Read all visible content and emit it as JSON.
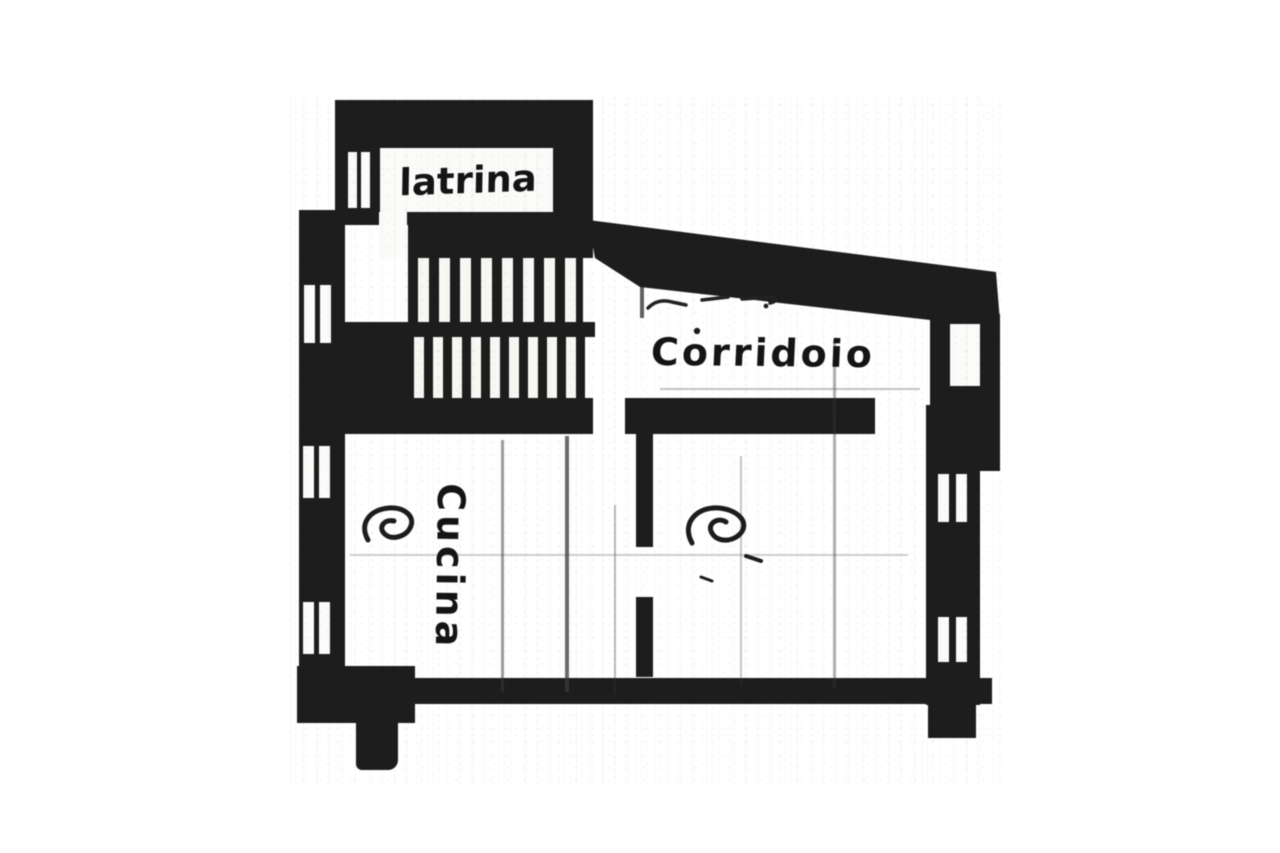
{
  "plan": {
    "rooms": [
      {
        "id": "latrina",
        "label": "latrina"
      },
      {
        "id": "corridoio",
        "label": "Corridoio"
      },
      {
        "id": "cucina",
        "label": "Cucina"
      }
    ],
    "colors": {
      "ink": "#1d1d1d",
      "paper": "#ffffff"
    },
    "symbols": {
      "staircase": "hatch-stripes",
      "window": "double-slit",
      "fixture": "scribble-loop"
    }
  }
}
